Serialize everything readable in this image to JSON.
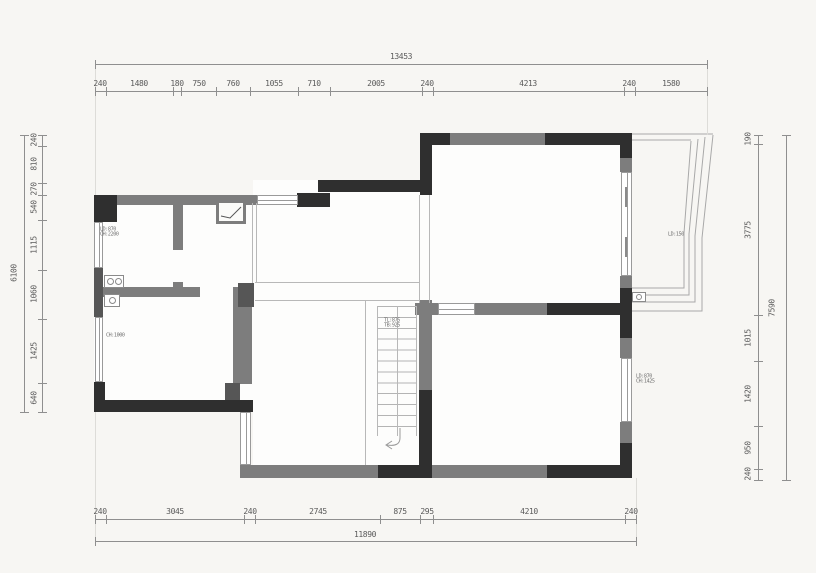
{
  "drawing": {
    "type": "floor-plan",
    "colors": {
      "wall_dark": "#2f2f2f",
      "wall_gray": "#7d7d7d",
      "wall_mid": "#565656",
      "dim_text": "#5a5a5a",
      "background": "#f7f6f3"
    },
    "dimensions": {
      "top": {
        "total": "13453",
        "segments": [
          "240",
          "1480",
          "180",
          "750",
          "760",
          "1055",
          "710",
          "2005",
          "240",
          "4213",
          "240",
          "1580"
        ]
      },
      "bottom": {
        "total": "11890",
        "segments": [
          "240",
          "3045",
          "240",
          "2745",
          "875",
          "295",
          "4210",
          "240"
        ]
      },
      "left": {
        "total": "6100",
        "segments": [
          "240",
          "810",
          "270",
          "540",
          "1115",
          "1060",
          "1425",
          "640"
        ]
      },
      "right": {
        "total": "7590",
        "segments": [
          "190",
          "3775",
          "1015",
          "1420",
          "950",
          "240"
        ]
      }
    },
    "annotations": {
      "closet": "LD:870\nCH:2200",
      "storage": "CH:1000",
      "stair": "TL:875\nTB:925",
      "balcony": "LD:150",
      "bedroom": "LD:870\nCH:1425"
    }
  }
}
